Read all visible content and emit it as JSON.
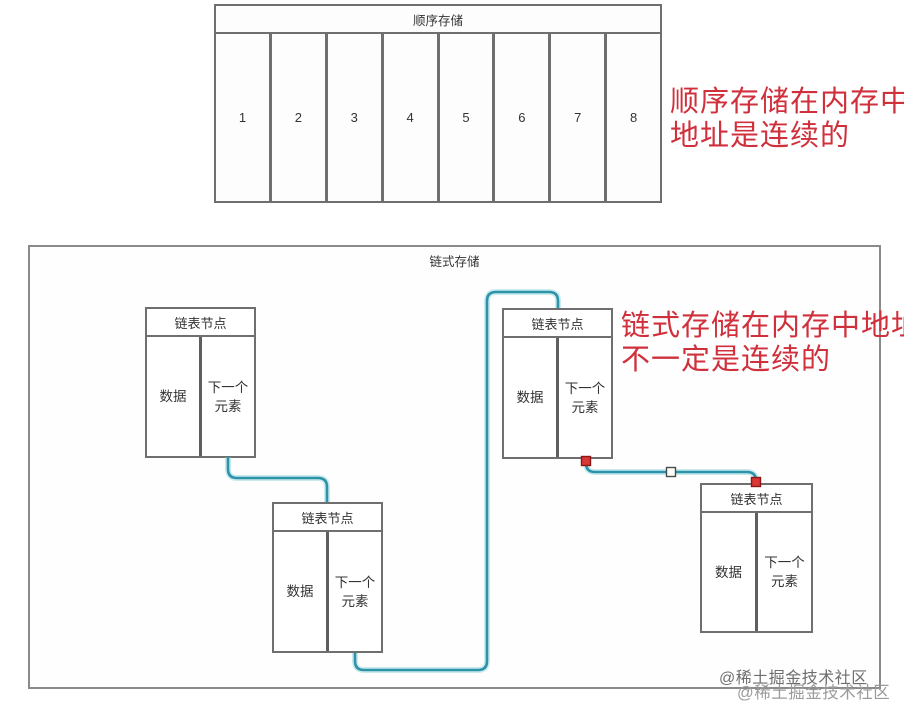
{
  "sequential": {
    "title": "顺序存储",
    "cells": [
      "1",
      "2",
      "3",
      "4",
      "5",
      "6",
      "7",
      "8"
    ],
    "annotation": {
      "line1": "顺序存储在内存中",
      "line2": "地址是连续的"
    }
  },
  "linked": {
    "title": "链式存储",
    "annotation": {
      "line1": "链式存储在内存中地址",
      "line2": "不一定是连续的"
    },
    "nodes": [
      {
        "title": "链表节点",
        "data_label": "数据",
        "next_line1": "下一个",
        "next_line2": "元素"
      },
      {
        "title": "链表节点",
        "data_label": "数据",
        "next_line1": "下一个",
        "next_line2": "元素"
      },
      {
        "title": "链表节点",
        "data_label": "数据",
        "next_line1": "下一个",
        "next_line2": "元素"
      },
      {
        "title": "链表节点",
        "data_label": "数据",
        "next_line1": "下一个",
        "next_line2": "元素"
      }
    ]
  },
  "watermarks": {
    "primary": "@稀土掘金技术社区",
    "secondary": "@稀土掘金技术社区"
  },
  "colors": {
    "connector_teal": "#2d93a8",
    "annotation_red": "#d0303c",
    "border_gray": "#6f6f6f",
    "endpoint_red": "#d93636"
  }
}
